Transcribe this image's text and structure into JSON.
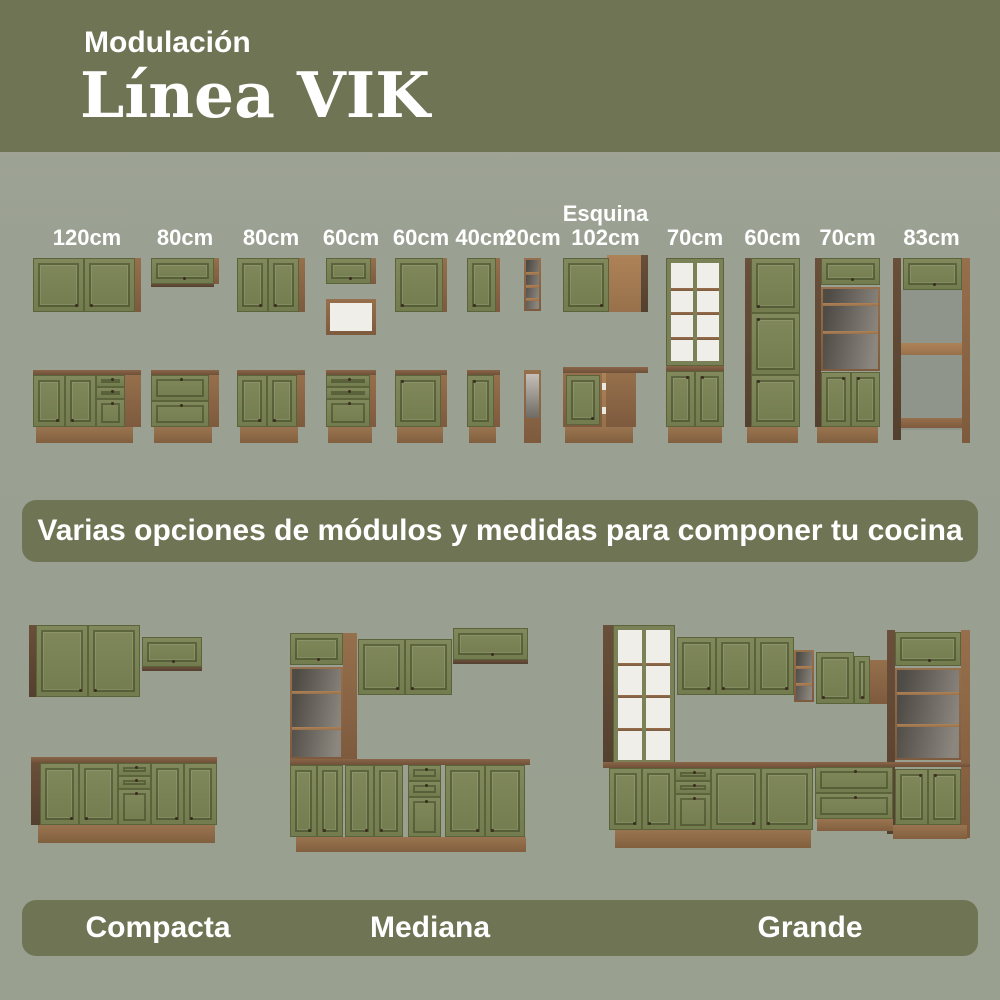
{
  "header": {
    "kicker": "Modulación",
    "title": "Línea VIK"
  },
  "modules": {
    "columns": [
      {
        "label": "120cm",
        "top": "wall-cabinet-two-doors",
        "bottom": "base-two-doors-three-drawers"
      },
      {
        "label": "80cm",
        "top": "wall-cabinet-flap",
        "bottom": "base-two-drawers"
      },
      {
        "label": "80cm",
        "top": "wall-cabinet-two-doors",
        "bottom": "base-two-doors"
      },
      {
        "label": "60cm",
        "top": "wall-cabinet-flap-with-open-niche",
        "bottom": "base-three-drawers"
      },
      {
        "label": "60cm",
        "top": "wall-cabinet-one-door",
        "bottom": "base-one-door"
      },
      {
        "label": "40cm",
        "top": "wall-cabinet-one-door",
        "bottom": "base-one-door"
      },
      {
        "label": "20cm",
        "top": "wall-open-shelf-unit",
        "bottom": "base-open-tall-unit"
      },
      {
        "label": "Esquina 102cm",
        "top": "corner-wall-cabinet",
        "bottom": "corner-base-cabinet"
      },
      {
        "label": "70cm",
        "tall": "tall-glass-door-cabinet"
      },
      {
        "label": "60cm",
        "tall": "tall-pantry-cabinet"
      },
      {
        "label": "70cm",
        "tall": "tall-oven-tower"
      },
      {
        "label": "83cm",
        "tall": "tall-open-tower"
      }
    ]
  },
  "banner": {
    "text": "Varias opciones de módulos y medidas para componer tu cocina"
  },
  "kitchens": [
    {
      "name": "Compacta"
    },
    {
      "name": "Mediana"
    },
    {
      "name": "Grande"
    }
  ],
  "colors": {
    "olive": "#6F7454",
    "background": "#9AA092",
    "cabinet_green": "#7A8157",
    "wood_mid": "#8A6647",
    "wood_dark": "#5E4634",
    "text_white": "#FFFFFF"
  }
}
